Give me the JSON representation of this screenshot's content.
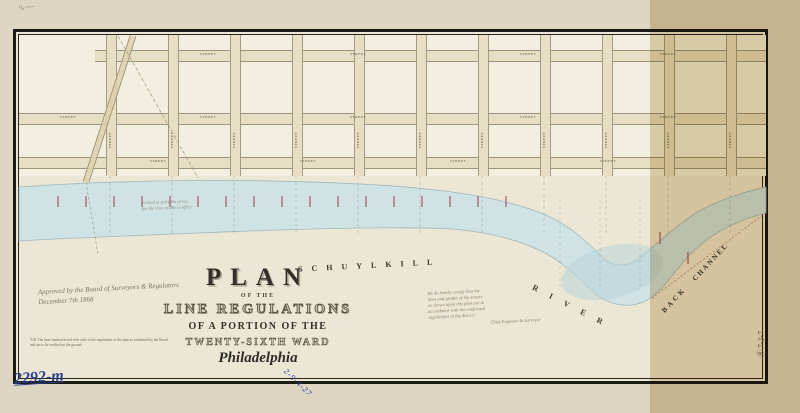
{
  "map": {
    "title_block": {
      "plan": "PLAN",
      "of_the": "OF THE",
      "line_regulations": "LINE REGULATIONS",
      "of_a_portion": "OF A PORTION OF THE",
      "ward": "TWENTY-SIXTH WARD",
      "city": "Philadelphia"
    },
    "river_labels": {
      "schuylkill": "SCHUYLKILL",
      "river": "RIVER",
      "back": "BACK",
      "channel": "CHANNEL"
    },
    "streets": {
      "generic_label": "STREET"
    },
    "handwritten": {
      "approval_line1": "Approved by the Board of Surveyors & Regulators",
      "approval_line2": "December 7th 1868",
      "certification_lines": [
        "We do hereby certify that the",
        "lines and grades of the streets",
        "as shown upon this plan are in",
        "accordance with the confirmed",
        "regulations of the district",
        "Chief Engineer & Surveyor"
      ],
      "pencil_note_line1": "revised to suit plan of reg.",
      "pencil_note_line2": "for the lines on file in office",
      "footnote_line1": "N.B. The lines marked in red refer only to the regulations of the plan as confirmed by the Board",
      "footnote_line2": "and are to be verified on the ground."
    },
    "ink_marks": {
      "bottom_left_number": "2292-m",
      "bottom_center_scrawl": "2-9-4-27",
      "right_margin_mark": "Ⓑ 7-2-7",
      "top_left_scribble": "∿⁓"
    },
    "colors": {
      "paper": "#dbd5c1",
      "map_paper": "#ece7d5",
      "block": "#f2efe0",
      "street": "#e7dfc4",
      "river": "#cfe2e4",
      "river_deep": "#b9d3d8",
      "tan_band": "#c6a86c",
      "red_tick": "#a8505c",
      "blue_ink": "#2b3f8e",
      "frame": "#1b1a15"
    }
  }
}
